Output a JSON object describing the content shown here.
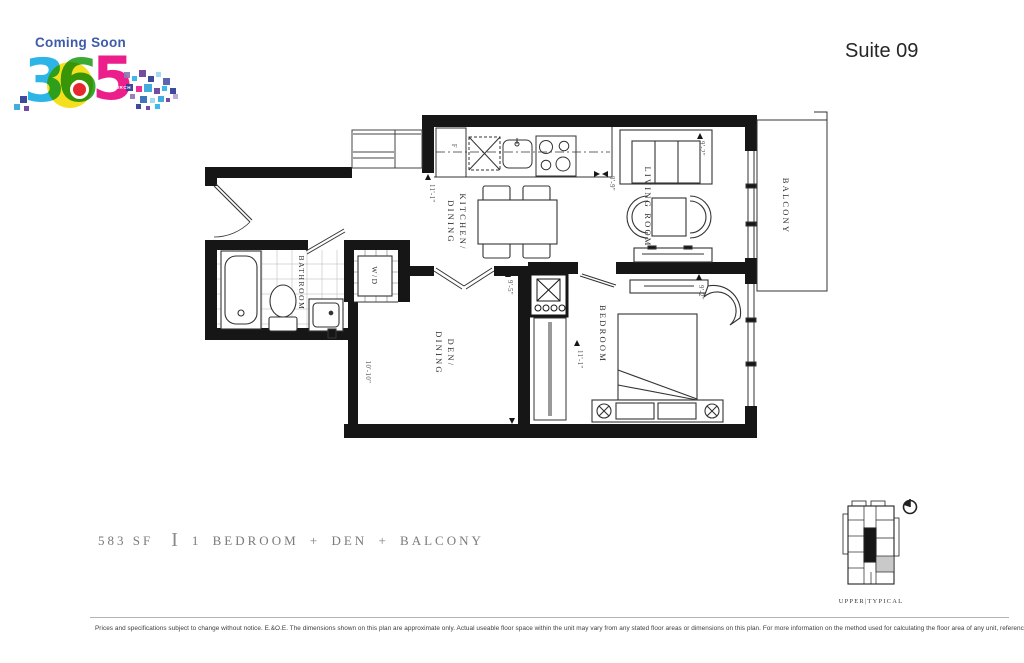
{
  "header": {
    "coming_soon": "Coming Soon",
    "suite": "Suite 09",
    "logo": {
      "digit3": "3",
      "digit6": "6",
      "digit5": "5",
      "church": "CHURCH"
    }
  },
  "floorplan": {
    "labels": {
      "kitchen_line1": "KITCHEN/",
      "kitchen_line2": "DINING",
      "living": "LIVING ROOM",
      "bedroom": "BEDROOM",
      "bathroom": "BATHROOM",
      "den_line1": "DEN/",
      "den_line2": "DINING",
      "wd": "W/D",
      "balcony": "BALCONY",
      "fridge": "F"
    },
    "dims": {
      "kitchen": "11'-1\"",
      "living_width": "8'-9\"",
      "living_depth": "9'-2\"",
      "den_height": "10'-10\"",
      "den_width": "9'-5\"",
      "bedroom_height": "11'-1\"",
      "bedroom_width": "9'-2\""
    }
  },
  "keyplan": {
    "caption": "UPPER|TYPICAL"
  },
  "summary": {
    "area": "583 SF",
    "divider": "I",
    "type": "1 BEDROOM + DEN + BALCONY"
  },
  "footer": {
    "disclaimer": "Prices and specifications subject to change without notice. E.&O.E. The dimensions shown on this plan are approximate only. Actual useable floor space within the unit may vary from any stated floor areas or dimensions on this plan. For more information on the method used for calculating the floor area of any unit, reference should be made to Builder Bulletin No. 22 published by Tarion."
  },
  "logo": {
    "colors": {
      "coming_soon": "#3d5ba9",
      "digit3": "#2eb5e8",
      "digit6": "#3aaa35",
      "digit5": "#ec1e8c",
      "yellow": "#f5e01e",
      "red": "#e8262d"
    },
    "pixels": [
      {
        "x": 124,
        "y": 72,
        "s": 6,
        "c": "#8f79b8"
      },
      {
        "x": 132,
        "y": 76,
        "s": 5,
        "c": "#2eb5e8"
      },
      {
        "x": 139,
        "y": 70,
        "s": 7,
        "c": "#6b3f97"
      },
      {
        "x": 148,
        "y": 76,
        "s": 6,
        "c": "#2f3d94"
      },
      {
        "x": 156,
        "y": 72,
        "s": 5,
        "c": "#9ad7f0"
      },
      {
        "x": 163,
        "y": 78,
        "s": 7,
        "c": "#4f5aa8"
      },
      {
        "x": 126,
        "y": 84,
        "s": 7,
        "c": "#2f3d94"
      },
      {
        "x": 136,
        "y": 86,
        "s": 6,
        "c": "#ec1e8c"
      },
      {
        "x": 144,
        "y": 84,
        "s": 8,
        "c": "#35a8dc"
      },
      {
        "x": 154,
        "y": 88,
        "s": 6,
        "c": "#6b3f97"
      },
      {
        "x": 162,
        "y": 86,
        "s": 5,
        "c": "#2eb5e8"
      },
      {
        "x": 170,
        "y": 88,
        "s": 6,
        "c": "#2f3d94"
      },
      {
        "x": 130,
        "y": 94,
        "s": 5,
        "c": "#8f79b8"
      },
      {
        "x": 140,
        "y": 96,
        "s": 7,
        "c": "#2f6db4"
      },
      {
        "x": 150,
        "y": 98,
        "s": 5,
        "c": "#9ad7f0"
      },
      {
        "x": 158,
        "y": 96,
        "s": 6,
        "c": "#35a8dc"
      },
      {
        "x": 166,
        "y": 98,
        "s": 4,
        "c": "#6b3f97"
      },
      {
        "x": 173,
        "y": 94,
        "s": 5,
        "c": "#b9a6d4"
      },
      {
        "x": 136,
        "y": 104,
        "s": 5,
        "c": "#2f3d94"
      },
      {
        "x": 146,
        "y": 106,
        "s": 4,
        "c": "#6b3f97"
      },
      {
        "x": 155,
        "y": 104,
        "s": 5,
        "c": "#2eb5e8"
      },
      {
        "x": 20,
        "y": 96,
        "s": 7,
        "c": "#2f3d94"
      },
      {
        "x": 14,
        "y": 104,
        "s": 6,
        "c": "#35a8dc"
      },
      {
        "x": 24,
        "y": 106,
        "s": 5,
        "c": "#6b3f97"
      }
    ]
  }
}
